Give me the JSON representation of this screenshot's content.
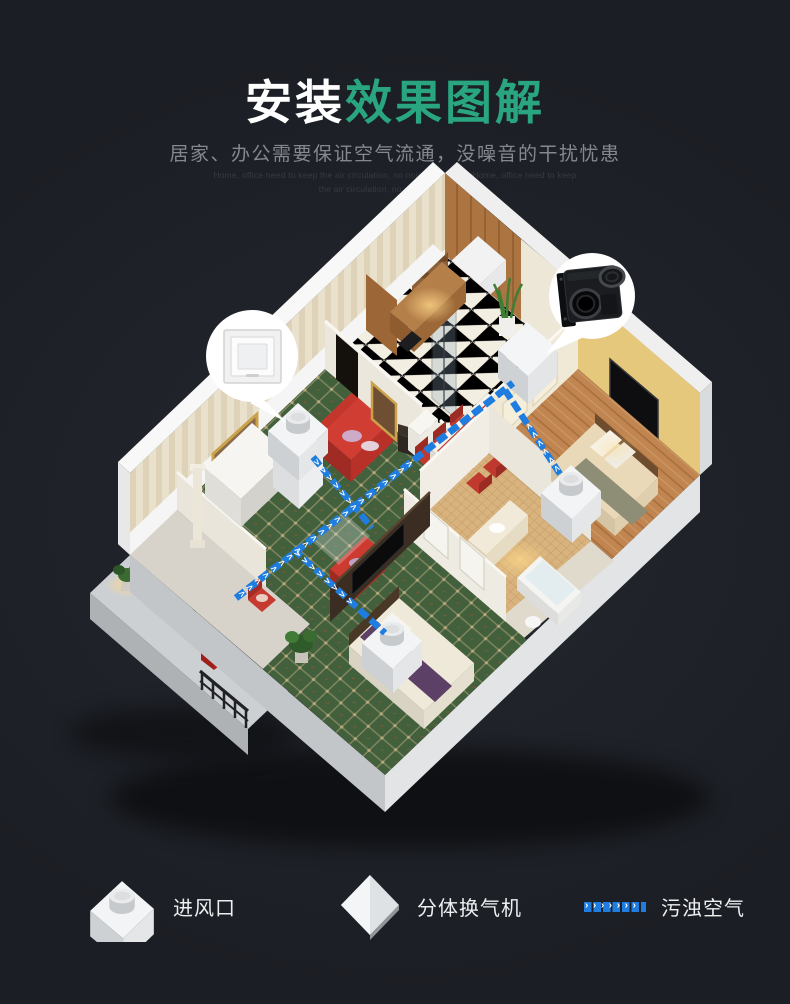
{
  "header": {
    "title": {
      "part1": "安装",
      "part2": "效果图解"
    },
    "subtitle": "居家、办公需要保证空气流通，没噪音的干扰忧患",
    "subtext_line1": "Home, office need to keep the air circulation, no noise worry copyHome, office need to keep",
    "subtext_line2": "the air circulation, no noise worry copy"
  },
  "diagram": {
    "callouts": {
      "left_icon": "ceiling-vent-panel-icon",
      "right_icon": "duct-fan-unit-icon"
    },
    "units": [
      "living-room-vent",
      "main-split-ventilator",
      "bedroom-right-vent",
      "bedroom-bottom-vent"
    ]
  },
  "legend": {
    "airflow_chevrons": "›››››››",
    "items": [
      {
        "label": "进风口",
        "icon": "inlet-unit-3d-icon"
      },
      {
        "label": "分体换气机",
        "icon": "ventilator-diamond-icon"
      },
      {
        "label": "污浊空气",
        "icon": "blue-dashed-airflow-icon"
      }
    ]
  },
  "colors": {
    "background": "#1d2027",
    "title_primary": "#ffffff",
    "title_accent": "#29a57f",
    "subtitle_gray": "#85888e",
    "airflow_blue": "#1f7de0"
  }
}
